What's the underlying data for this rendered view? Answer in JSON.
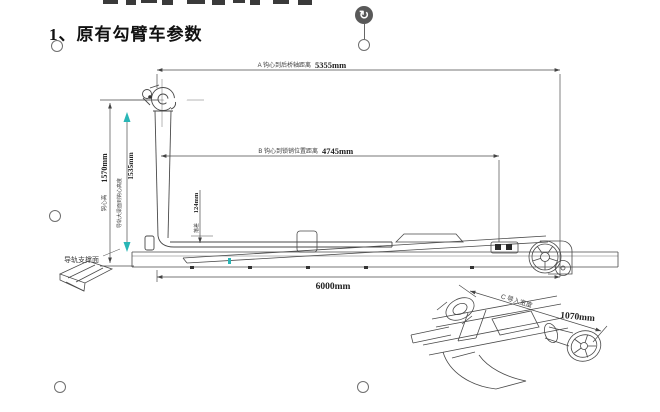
{
  "title": {
    "number": "1、",
    "text": "原有勾臂车参数"
  },
  "drawing": {
    "dim_a": {
      "label": "A 钩心到后桥轴距离",
      "value": "5355mm"
    },
    "dim_b": {
      "label": "B 钩心到锁销位置距离",
      "value": "4745mm"
    },
    "dim_height": {
      "label": "钩心高",
      "value": "1570mm"
    },
    "dim_rail_height": {
      "label": "导轨大梁面到钩心高度",
      "value": "1535mm"
    },
    "dim_drop": {
      "label": "落差",
      "value": "124mm"
    },
    "dim_length": {
      "value": "6000mm"
    },
    "rail_surface_label": "导轨支撑面"
  },
  "detail": {
    "dim_c": {
      "label": "C 导入宽度",
      "value": "1070mm"
    }
  },
  "ui": {
    "rotate_icon": "↻"
  },
  "colors": {
    "accent_teal": "#29b6b6",
    "line": "#4a4a4a",
    "handle": "#595959"
  }
}
